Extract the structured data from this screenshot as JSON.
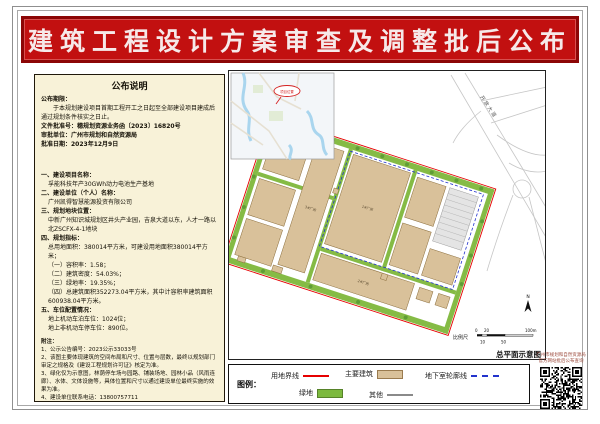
{
  "accent_color": "#c21010",
  "banner": {
    "title": "建筑工程设计方案审查及调整批后公布"
  },
  "notice": {
    "box_title": "公布说明",
    "period_label": "公布期限：",
    "period_text": "于本规划建设项目首期工程开工之日起至全部建设项目建成后通过规划条件核实之日止。",
    "doc_no": "文件批准号：穗规划资源业务函〔2023〕16820号",
    "approver": "审批单位：广州市规划和自然资源局",
    "approve_date": "批准日期：2023年12月9日",
    "sections": [
      {
        "label": "一、建设项目名称：",
        "lines": [
          "孚能科技年产30GWh动力电池生产基地"
        ]
      },
      {
        "label": "二、建设单位（个人）名称：",
        "lines": [
          "广州凯得智慧能源投资有限公司"
        ]
      },
      {
        "label": "三、规划地块位置：",
        "lines": [
          "中新广州知识城规划区井头产业园，吉泉大道以东，人才一路以北ZSCFX-4-1地块"
        ]
      },
      {
        "label": "四、规划指标：",
        "lines": [
          "总用地面积：380014平方米，可建设用地面积380014平方米；",
          "（一）容积率：1.58；",
          "（二）建筑密度：54.03%；",
          "（三）绿地率：19.35%；",
          "（四）总建筑面积352273.04平方米，其中计容积率建筑面积600938.04平方米。"
        ]
      },
      {
        "label": "五、车位配置情况：",
        "lines": [
          "地上机动车泊车位：1024位；",
          "地上非机动车停车位：890位。"
        ]
      }
    ],
    "notes_label": "附注：",
    "notes": [
      "1、公示公告编号：2023公示33033号",
      "2、该图主要体现建筑的空间布局和尺寸、位置与层数，最终以规划部门审定之规格及《建设工程规划许可证》核定为准。",
      "3、绿化仅为示意图，林荫停车场与园路、铺装场地、园林小品（风雨连廊）、水体、文体设施等，具体位置和尺寸以通过建设单位最终实施的效果为准。",
      "4、建设单位联系电话：13800757711",
      "5、查询网址：http://ghzyj.gz.gov.cn/zwgk/xzgh/ghwlgzgh/jzgh/gbh/"
    ]
  },
  "plan": {
    "sheet_label": "总平面示意图",
    "scale_label": "比例尺",
    "scale_tick_0": "0",
    "scale_tick_20": "20",
    "scale_tick_100": "100m",
    "scale_tick_10": "10",
    "scale_tick_50": "50",
    "north_label": "N",
    "inset_marker": "项目位置",
    "road_label": "开放大道",
    "building_labels": [
      "1#厂房",
      "2#厂房",
      "3#厂房",
      "4#厂房"
    ]
  },
  "legend": {
    "title": "图例：",
    "items": [
      {
        "label": "用地界线",
        "swatch": "red-line",
        "color": "#e60000"
      },
      {
        "label": "主要建筑",
        "swatch": "tan-fill",
        "color": "#d9c19a"
      },
      {
        "label": "地下室轮廓线",
        "swatch": "blue-dashed",
        "color": "#2233cc"
      },
      {
        "label": "绿地",
        "swatch": "green-fill",
        "color": "#7cb93e"
      },
      {
        "label": "其他",
        "swatch": "gray-line",
        "color": "#8a8a8a"
      }
    ]
  },
  "qr": {
    "caption_line1": "广州市规划和自然资源局",
    "caption_line2": "官方网站批后公布查询"
  }
}
